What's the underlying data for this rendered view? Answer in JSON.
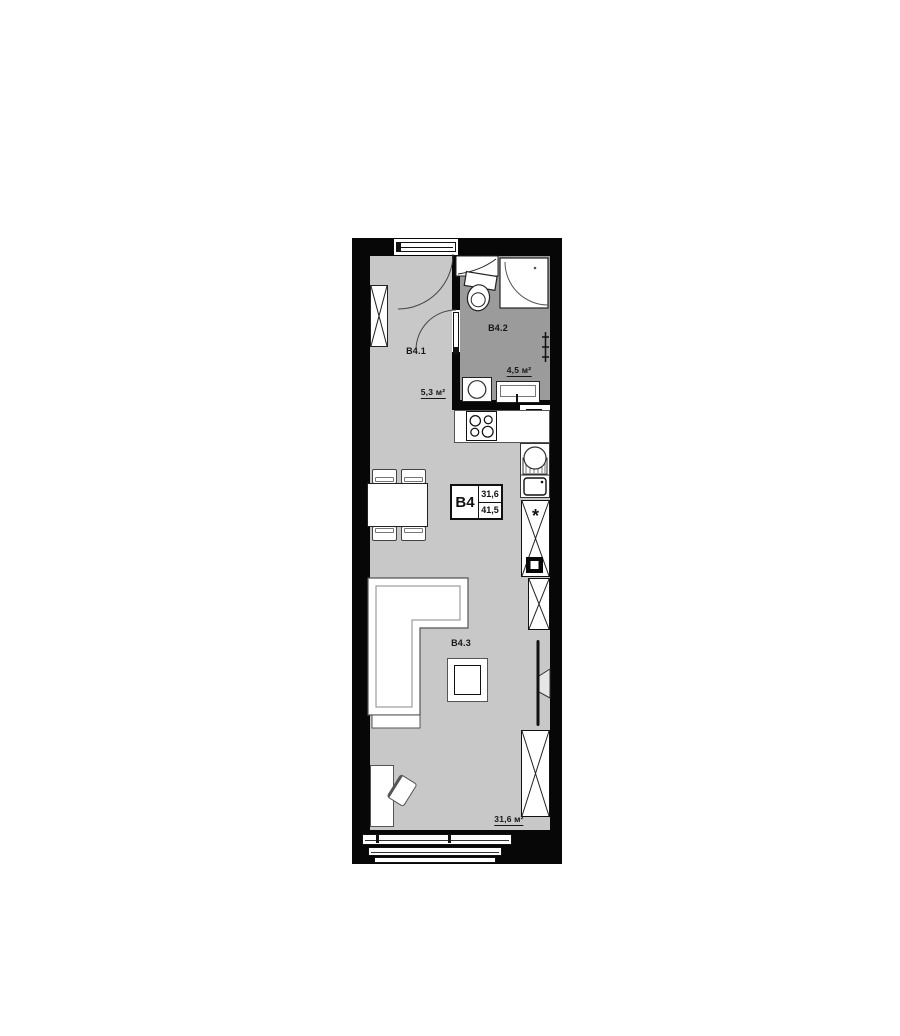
{
  "unit": {
    "code": "B4",
    "stats": {
      "living_area": "31,6",
      "total_area": "41,5"
    }
  },
  "rooms": [
    {
      "code": "B4.1",
      "area": "5,3 м²"
    },
    {
      "code": "B4.2",
      "area": "4,5 м²"
    },
    {
      "code": "B4.3",
      "area": "31,6 м²"
    }
  ],
  "symbols": {
    "fridge_mark": "*"
  },
  "colors": {
    "wall": "#070707",
    "floor_main": "#c8c8c8",
    "floor_bath": "#9b9b9b",
    "fixture": "#ffffff"
  }
}
